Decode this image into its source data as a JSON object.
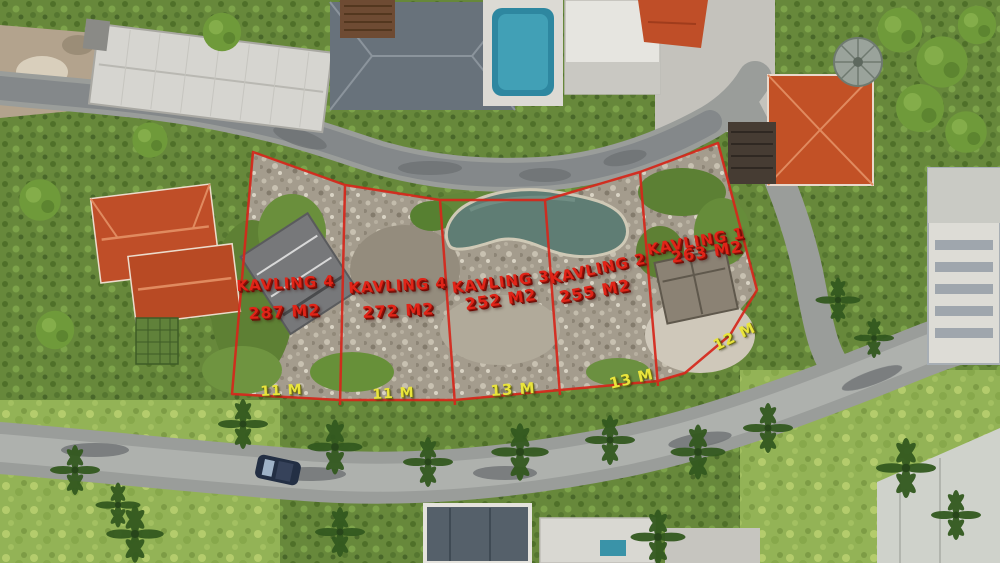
{
  "scene": {
    "type": "aerial-drone-photograph",
    "subject": "hillside land plots (kavling) for sale, marked with red boundary overlay among villas, roads and palm trees",
    "colors": {
      "vegetation_base": "#7d9a4a",
      "road_grey": "#9a9d9a",
      "plot_rubble": "#a59d8e",
      "pond_water": "#5f7d74",
      "pool_blue": "#2e87a0",
      "roof_orange": "#c25126",
      "roof_dark_slate": "#68727b",
      "boundary_red": "#d6271b",
      "label_red": "#e02418",
      "label_yellow": "#e9e43c"
    }
  },
  "overlay": {
    "plots": [
      {
        "name": "KAVLING 4",
        "area": "287 M2",
        "frontage": "11 M"
      },
      {
        "name": "KAVLING 4",
        "area": "272 M2",
        "frontage": "11 M"
      },
      {
        "name": "KAVLING 3",
        "area": "252 M2",
        "frontage": "13 M"
      },
      {
        "name": "KAVLING 2",
        "area": "255 M2",
        "frontage": "13 M"
      },
      {
        "name": "KAVLING 1",
        "area": "263 M2",
        "frontage": "12 M"
      }
    ]
  }
}
